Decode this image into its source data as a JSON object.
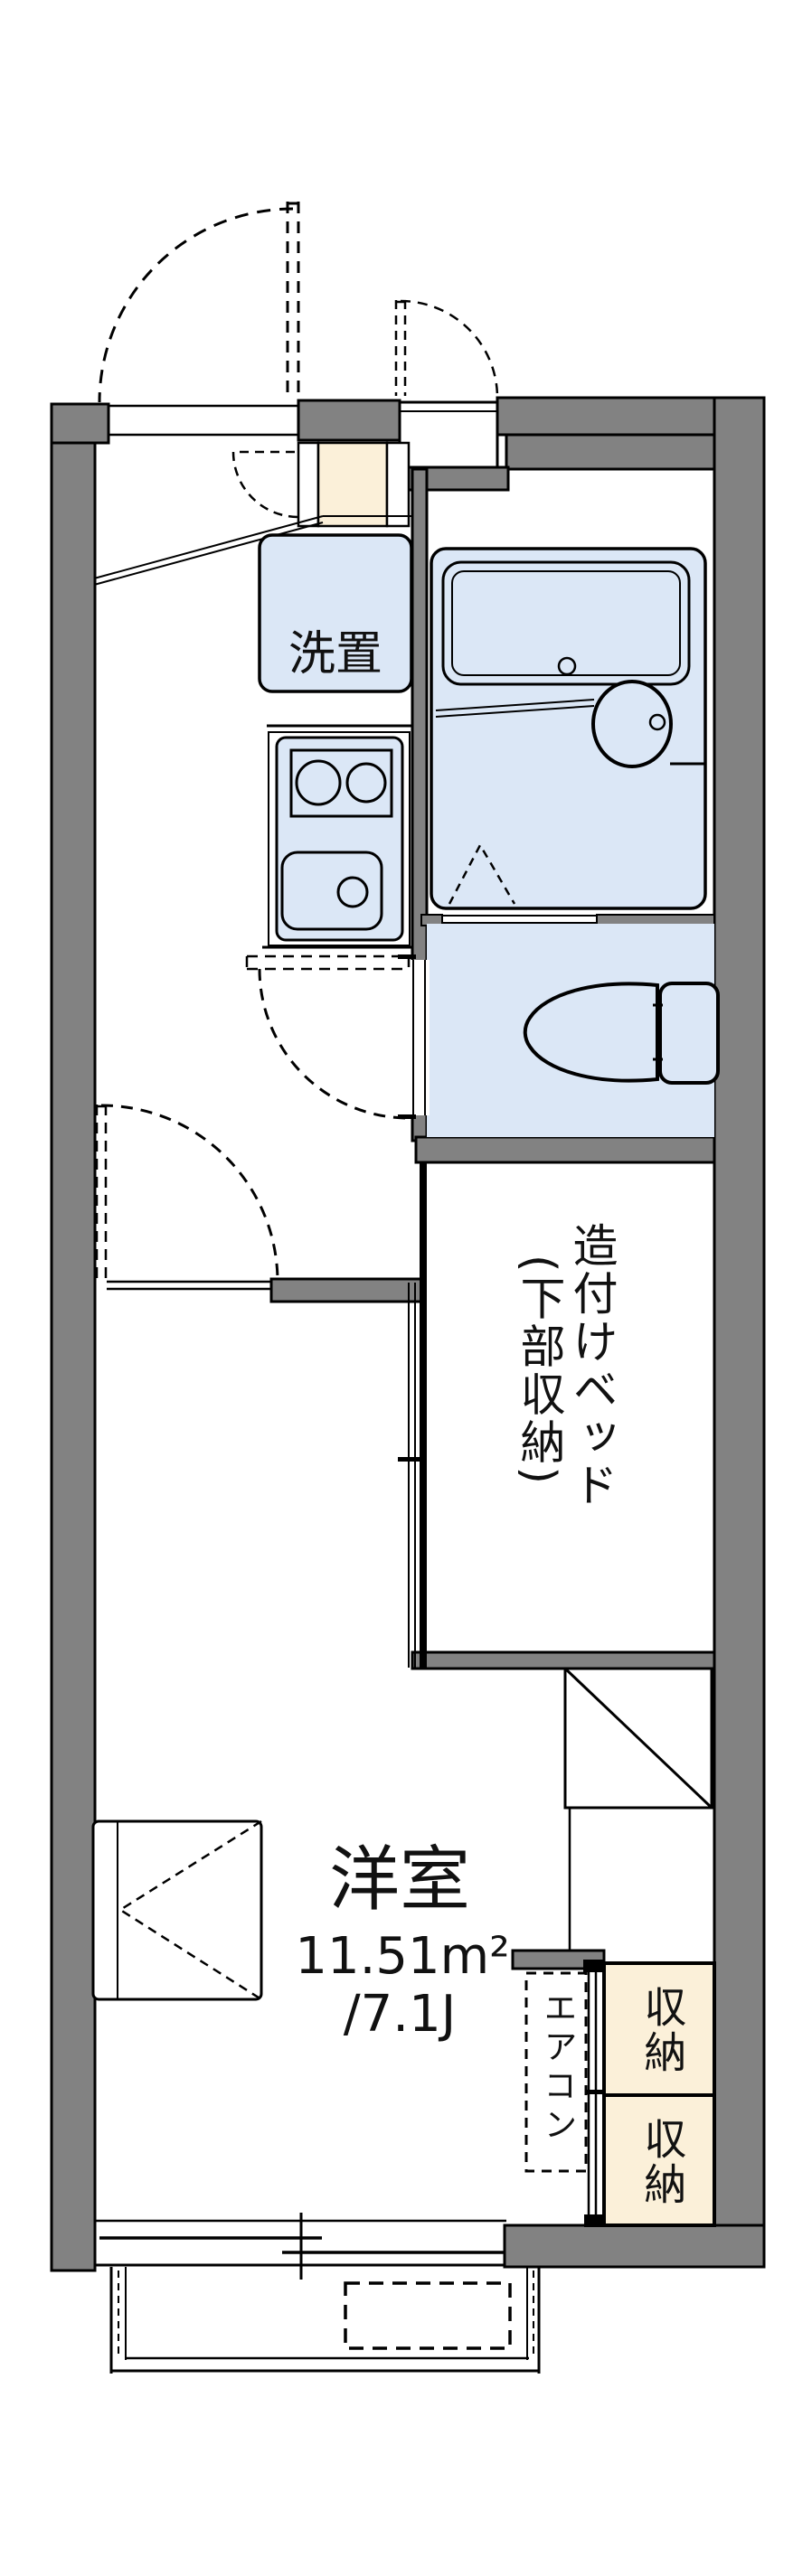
{
  "page": {
    "type": "apartment-floor-plan"
  },
  "colors": {
    "wall_gray": "#828282",
    "fixture_blue": "#dbe7f6",
    "storage_cream": "#fbf0d9",
    "outline_black": "#000000",
    "text": "#111111"
  },
  "labels": {
    "washer_area": "洗置",
    "built_in_bed": "造付けベッド",
    "under_bed_storage": "(下部収納)",
    "main_room_name": "洋室",
    "main_room_area_sqm": "11.51m²",
    "main_room_area_jo": "/7.1J",
    "air_conditioner": "エアコン",
    "storage_upper": "収納",
    "storage_lower": "収納"
  },
  "fixtures": [
    "entrance-door",
    "outdoor-storage-door",
    "shoe-cabinet",
    "entrance-step",
    "washing-machine-space",
    "gas-stove",
    "kitchen-sink",
    "refrigerator-space",
    "unit-bath",
    "bathtub",
    "wash-basin",
    "bath-folding-door",
    "toilet",
    "built-in-bed-room",
    "sliding-door",
    "folding-table",
    "air-conditioner-space",
    "storage-closet-upper",
    "storage-closet-lower",
    "sliding-window",
    "balcony"
  ]
}
